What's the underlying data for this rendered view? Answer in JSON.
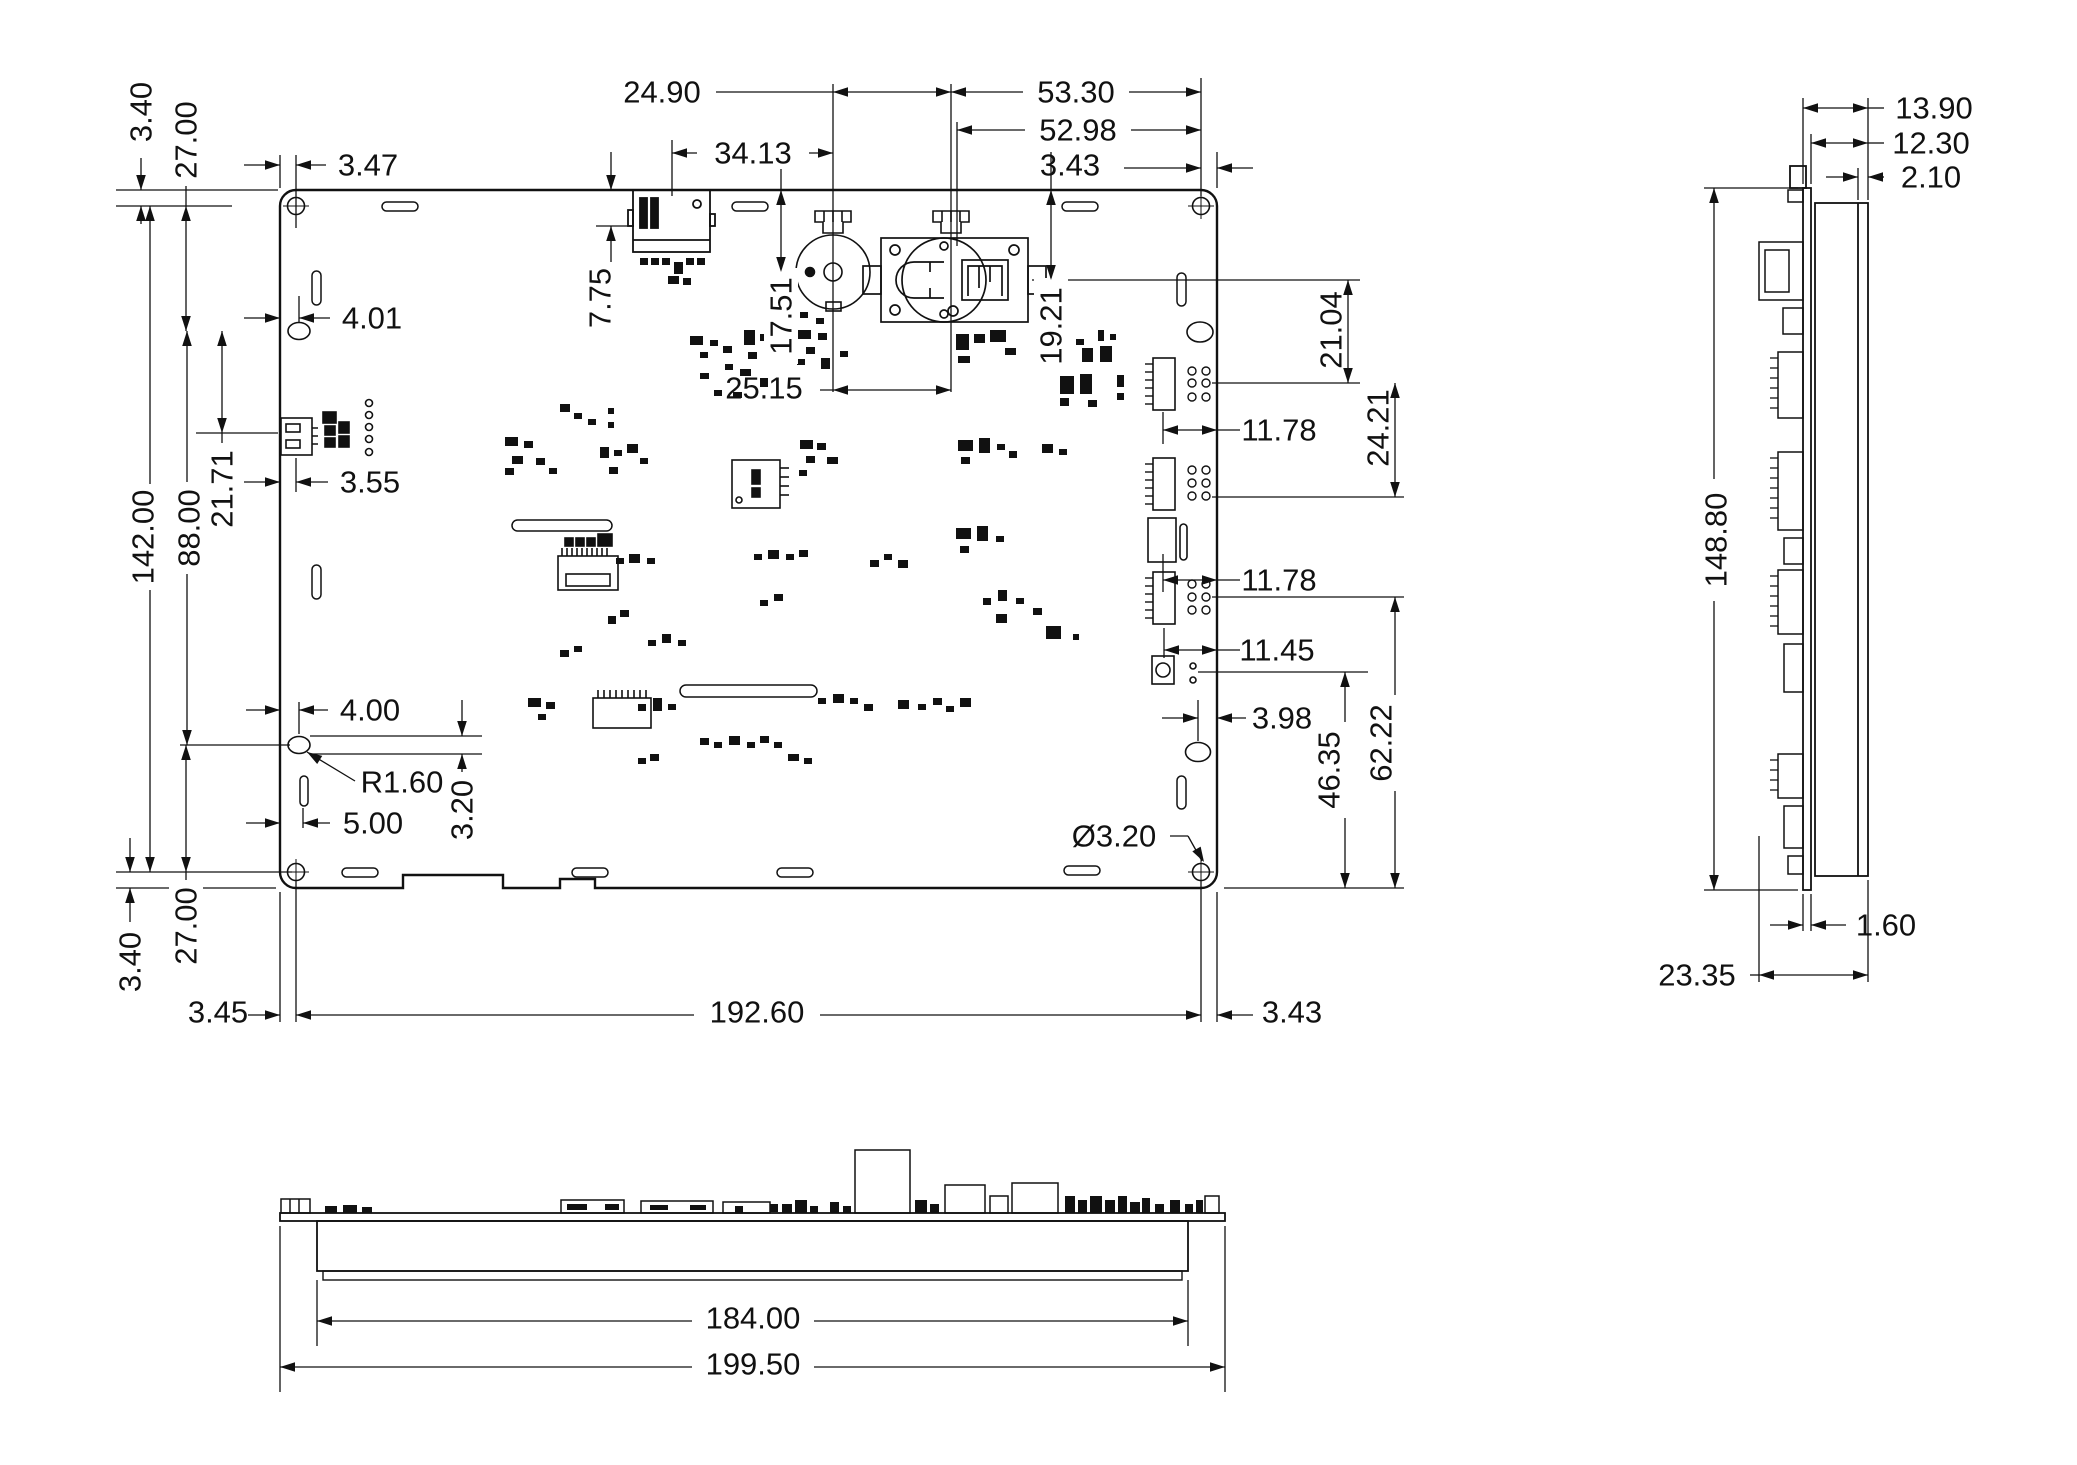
{
  "dims": {
    "t340": "3.40",
    "t2700": "27.00",
    "h347": "3.47",
    "h2490": "24.90",
    "h5330": "53.30",
    "h5298": "52.98",
    "h3413": "34.13",
    "h343t": "3.43",
    "v775": "7.75",
    "v1751": "17.51",
    "v1921": "19.21",
    "h401": "4.01",
    "h355": "3.55",
    "v14200": "142.00",
    "v8800": "88.00",
    "v2171": "21.71",
    "h2515": "25.15",
    "v2104": "21.04",
    "v2421": "24.21",
    "h1178a": "11.78",
    "h1178b": "11.78",
    "h1145": "11.45",
    "h398": "3.98",
    "v4635": "46.35",
    "v6222": "62.22",
    "h400": "4.00",
    "r160": "R1.60",
    "v320": "3.20",
    "h500": "5.00",
    "b2700": "27.00",
    "b340": "3.40",
    "h345": "3.45",
    "h19260": "192.60",
    "h343b": "3.43",
    "dia320": "Ø3.20",
    "s1390": "13.90",
    "s1230": "12.30",
    "s210": "2.10",
    "s14880": "148.80",
    "s160": "1.60",
    "s2335": "23.35",
    "b18400": "184.00",
    "b19950": "199.50"
  },
  "colors": {
    "line": "#111111",
    "background": "#ffffff"
  }
}
